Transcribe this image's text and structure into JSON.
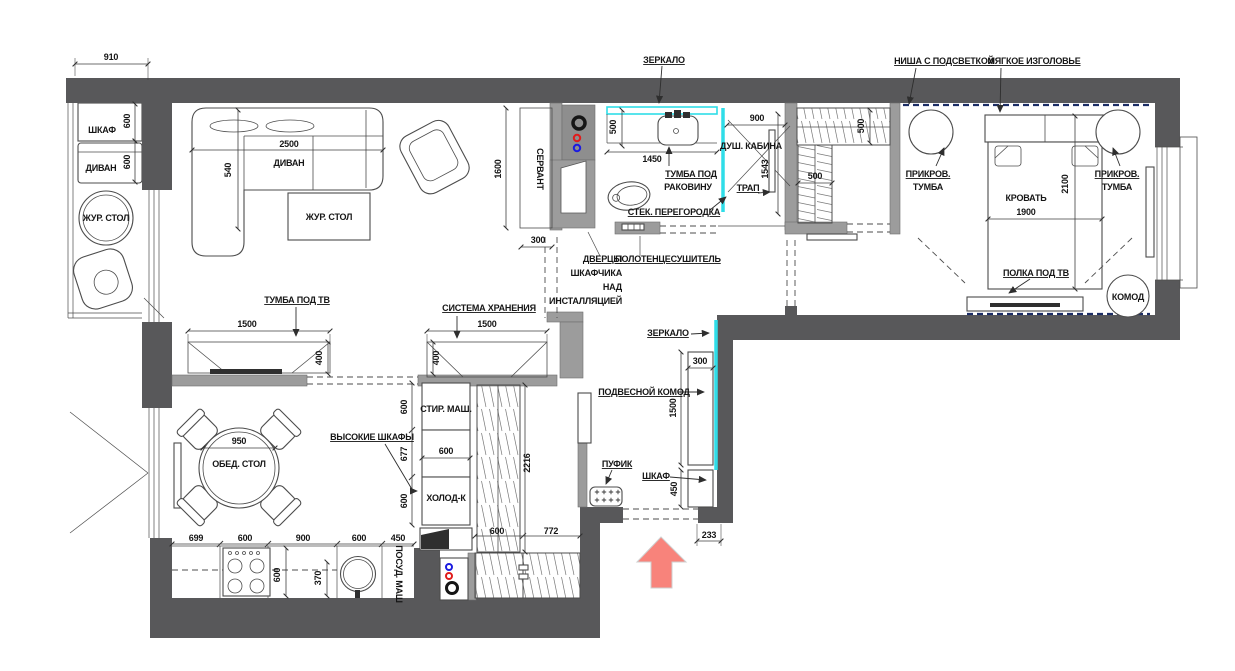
{
  "title": "План расстановки мебели",
  "colors": {
    "wall": "#58585a",
    "partition": "#9c9c9c",
    "accent": "#2fdde8",
    "arrow": "#f8837b",
    "led": "#1d2e66",
    "redpoint": "#e01b1b",
    "bluepoint": "#1b1be0"
  },
  "icons": {
    "entry_arrow": "entry-direction-arrow",
    "hot_water_point": "red-circle",
    "cold_water_point": "blue-circle",
    "sewage_point": "black-ring"
  },
  "labels": [
    {
      "id": "dim-910",
      "t": "910",
      "x": 111,
      "y": 60
    },
    {
      "id": "balcony-shkaf",
      "t": "ШКАФ",
      "x": 102,
      "y": 133
    },
    {
      "id": "dim-600-shkaf",
      "t": "600",
      "x": 130,
      "y": 121,
      "r": -90
    },
    {
      "id": "balcony-divan",
      "t": "ДИВАН",
      "x": 101,
      "y": 171
    },
    {
      "id": "dim-600-divan",
      "t": "600",
      "x": 130,
      "y": 162,
      "r": -90
    },
    {
      "id": "balcony-zhur-stol",
      "t": "ЖУР. СТОЛ",
      "x": 106,
      "y": 221,
      "fs": 7.5
    },
    {
      "id": "dim-2500",
      "t": "2500",
      "x": 289,
      "y": 147
    },
    {
      "id": "living-divan",
      "t": "ДИВАН",
      "x": 289,
      "y": 166
    },
    {
      "id": "dim-540",
      "t": "540",
      "x": 231,
      "y": 170,
      "r": -90
    },
    {
      "id": "living-zhur-stol",
      "t": "ЖУР. СТОЛ",
      "x": 329,
      "y": 220
    },
    {
      "id": "tumba-pod-tv",
      "t": "ТУМБА ПОД ТВ",
      "x": 297,
      "y": 303,
      "u": 1
    },
    {
      "id": "dim-1500-tv",
      "t": "1500",
      "x": 247,
      "y": 327
    },
    {
      "id": "dim-400-tv",
      "t": "400",
      "x": 322,
      "y": 358,
      "r": -90
    },
    {
      "id": "sistema-hraneniya",
      "t": "СИСТЕМА ХРАНЕНИЯ",
      "x": 489,
      "y": 311,
      "u": 1,
      "fs": 8.5
    },
    {
      "id": "dim-1500-storage",
      "t": "1500",
      "x": 487,
      "y": 327
    },
    {
      "id": "dim-400-storage",
      "t": "400",
      "x": 439,
      "y": 358,
      "r": -90
    },
    {
      "id": "dim-1600",
      "t": "1600",
      "x": 501,
      "y": 169,
      "r": -90
    },
    {
      "id": "servant",
      "t": "СЕРВАНТ",
      "x": 537,
      "y": 169,
      "r": 90
    },
    {
      "id": "dim-300-servant",
      "t": "300",
      "x": 538,
      "y": 243
    },
    {
      "id": "zerkalo-bath",
      "t": "ЗЕРКАЛО",
      "x": 664,
      "y": 63,
      "u": 1
    },
    {
      "id": "dim-500-bath",
      "t": "500",
      "x": 616,
      "y": 127,
      "r": -90
    },
    {
      "id": "dim-1450",
      "t": "1450",
      "x": 652,
      "y": 162
    },
    {
      "id": "tumba-rakovinu-1",
      "t": "ТУМБА ПОД",
      "x": 691,
      "y": 177,
      "u": 1
    },
    {
      "id": "tumba-rakovinu-2",
      "t": "РАКОВИНУ",
      "x": 688,
      "y": 190
    },
    {
      "id": "dush-kabina",
      "t": "ДУШ. КАБИНА",
      "x": 751,
      "y": 149,
      "fs": 9.5
    },
    {
      "id": "dim-900-shower",
      "t": "900",
      "x": 757,
      "y": 121
    },
    {
      "id": "dim-1543",
      "t": "1543",
      "x": 768,
      "y": 169,
      "r": -90
    },
    {
      "id": "trap",
      "t": "ТРАП",
      "x": 748,
      "y": 191,
      "u": 1
    },
    {
      "id": "stek-peregorodka",
      "t": "СТЕК. ПЕРЕГОРОДКА",
      "x": 674,
      "y": 215,
      "u": 1,
      "fs": 8.5
    },
    {
      "id": "dvertsy-1",
      "t": "ДВЕРЦЫ",
      "x": 622,
      "y": 262,
      "u": 1,
      "a": "e"
    },
    {
      "id": "dvertsy-2",
      "t": "ШКАФЧИКА",
      "x": 622,
      "y": 276,
      "a": "e"
    },
    {
      "id": "dvertsy-3",
      "t": "НАД",
      "x": 622,
      "y": 290,
      "a": "e"
    },
    {
      "id": "dvertsy-4",
      "t": "ИНСТАЛЛЯЦИЕЙ",
      "x": 622,
      "y": 304,
      "a": "e"
    },
    {
      "id": "polotentsesushitel",
      "t": "ПОЛОТЕНЦЕСУШИТЕЛЬ",
      "x": 668,
      "y": 262,
      "u": 1,
      "fs": 8.5
    },
    {
      "id": "dim-500-closet-v",
      "t": "500",
      "x": 864,
      "y": 126,
      "r": -90
    },
    {
      "id": "dim-500-closet-h",
      "t": "500",
      "x": 815,
      "y": 179
    },
    {
      "id": "nisha",
      "t": "НИША С ПОДСВЕТКОЙ",
      "x": 944,
      "y": 64,
      "u": 1,
      "fs": 8.5
    },
    {
      "id": "izgolovye",
      "t": "МЯГКОЕ ИЗГОЛОВЬЕ",
      "x": 1034,
      "y": 64,
      "u": 1,
      "fs": 8.5
    },
    {
      "id": "prikrov-left-1",
      "t": "ПРИКРОВ.",
      "x": 928,
      "y": 177,
      "u": 1
    },
    {
      "id": "prikrov-left-2",
      "t": "ТУМБА",
      "x": 928,
      "y": 190
    },
    {
      "id": "krovat",
      "t": "КРОВАТЬ",
      "x": 1026,
      "y": 201
    },
    {
      "id": "dim-1900",
      "t": "1900",
      "x": 1026,
      "y": 215
    },
    {
      "id": "dim-2100",
      "t": "2100",
      "x": 1068,
      "y": 184,
      "r": -90
    },
    {
      "id": "prikrov-right-1",
      "t": "ПРИКРОВ.",
      "x": 1117,
      "y": 177,
      "u": 1
    },
    {
      "id": "prikrov-right-2",
      "t": "ТУМБА",
      "x": 1117,
      "y": 190
    },
    {
      "id": "polka-pod-tv",
      "t": "ПОЛКА ПОД ТВ",
      "x": 1036,
      "y": 276,
      "u": 1
    },
    {
      "id": "komod-bedroom",
      "t": "КОМОД",
      "x": 1128,
      "y": 300,
      "fs": 8.5
    },
    {
      "id": "zerkalo-hall",
      "t": "ЗЕРКАЛО",
      "x": 668,
      "y": 336,
      "u": 1
    },
    {
      "id": "dim-300-hall",
      "t": "300",
      "x": 700,
      "y": 364
    },
    {
      "id": "podvesnoy-komod",
      "t": "ПОДВЕСНОЙ КОМОД",
      "x": 644,
      "y": 395,
      "u": 1,
      "fs": 8.5
    },
    {
      "id": "dim-1500-hall",
      "t": "1500",
      "x": 676,
      "y": 408,
      "r": -90
    },
    {
      "id": "pufik",
      "t": "ПУФИК",
      "x": 617,
      "y": 467,
      "u": 1
    },
    {
      "id": "shkaf-hall",
      "t": "ШКАФ",
      "x": 656,
      "y": 479,
      "u": 1
    },
    {
      "id": "dim-450-hall",
      "t": "450",
      "x": 677,
      "y": 489,
      "r": -90
    },
    {
      "id": "dim-233",
      "t": "233",
      "x": 709,
      "y": 538
    },
    {
      "id": "vysokie-shkafy",
      "t": "ВЫСОКИЕ ШКАФЫ",
      "x": 372,
      "y": 440,
      "u": 1
    },
    {
      "id": "dim-950",
      "t": "950",
      "x": 239,
      "y": 444
    },
    {
      "id": "obed-stol",
      "t": "ОБЕД. СТОЛ",
      "x": 239,
      "y": 467
    },
    {
      "id": "stir-mash",
      "t": "СТИР. МАШ.",
      "x": 446,
      "y": 412
    },
    {
      "id": "dim-600-stir",
      "t": "600",
      "x": 407,
      "y": 407,
      "r": -90
    },
    {
      "id": "dim-600-mid",
      "t": "600",
      "x": 446,
      "y": 454
    },
    {
      "id": "dim-677",
      "t": "677",
      "x": 407,
      "y": 454,
      "r": -90
    },
    {
      "id": "holod-k",
      "t": "ХОЛОД-К",
      "x": 446,
      "y": 501
    },
    {
      "id": "dim-600-holod",
      "t": "600",
      "x": 407,
      "y": 501,
      "r": -90
    },
    {
      "id": "dim-2216",
      "t": "2216",
      "x": 530,
      "y": 463,
      "r": -90
    },
    {
      "id": "dim-699",
      "t": "699",
      "x": 196,
      "y": 541
    },
    {
      "id": "dim-600-k1",
      "t": "600",
      "x": 245,
      "y": 541
    },
    {
      "id": "dim-900-k",
      "t": "900",
      "x": 303,
      "y": 541
    },
    {
      "id": "dim-600-k2",
      "t": "600",
      "x": 359,
      "y": 541
    },
    {
      "id": "dim-450-k",
      "t": "450",
      "x": 398,
      "y": 541
    },
    {
      "id": "dim-600-stove",
      "t": "600",
      "x": 280,
      "y": 575,
      "r": -90
    },
    {
      "id": "dim-370",
      "t": "370",
      "x": 321,
      "y": 578,
      "r": -90
    },
    {
      "id": "posud-mash",
      "t": "ПОСУД. МАШ",
      "x": 396,
      "y": 574,
      "r": 90,
      "fs": 7.5
    },
    {
      "id": "dim-600-entry",
      "t": "600",
      "x": 497,
      "y": 534
    },
    {
      "id": "dim-772",
      "t": "772",
      "x": 551,
      "y": 534
    }
  ]
}
